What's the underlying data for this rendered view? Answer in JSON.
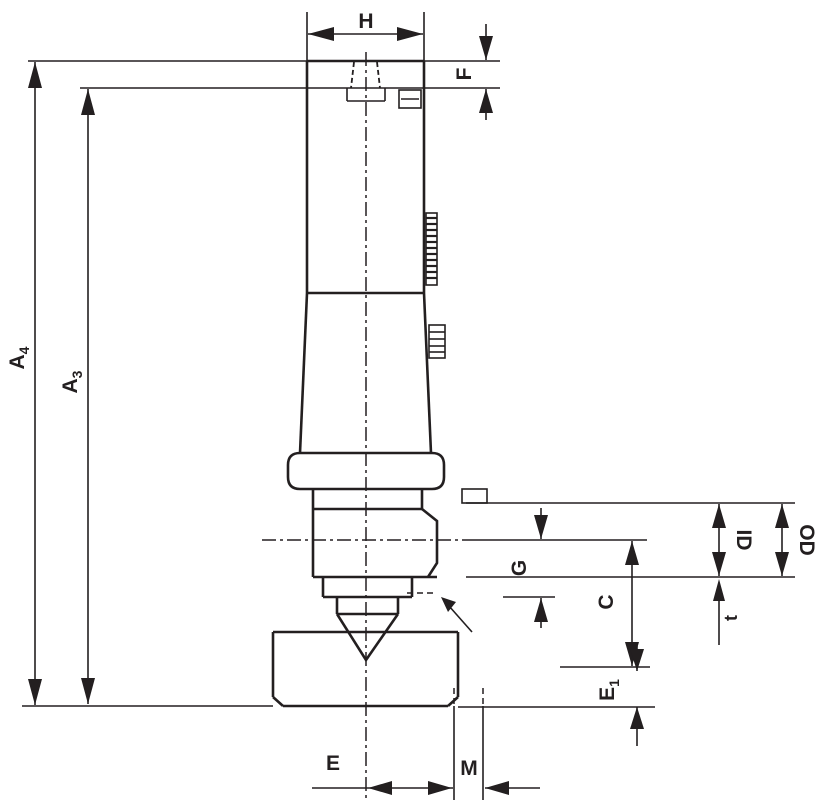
{
  "drawing": {
    "background": "#ffffff",
    "stroke_color": "#231f20",
    "labels": {
      "h": "H",
      "f": "F",
      "a4": {
        "base": "A",
        "sub": "4"
      },
      "a3": {
        "base": "A",
        "sub": "3"
      },
      "id": "ID",
      "od": "OD",
      "g": "G",
      "c": "C",
      "t": "t",
      "e1": {
        "base": "E",
        "sub": "1"
      },
      "e": "E",
      "m": "M"
    }
  }
}
